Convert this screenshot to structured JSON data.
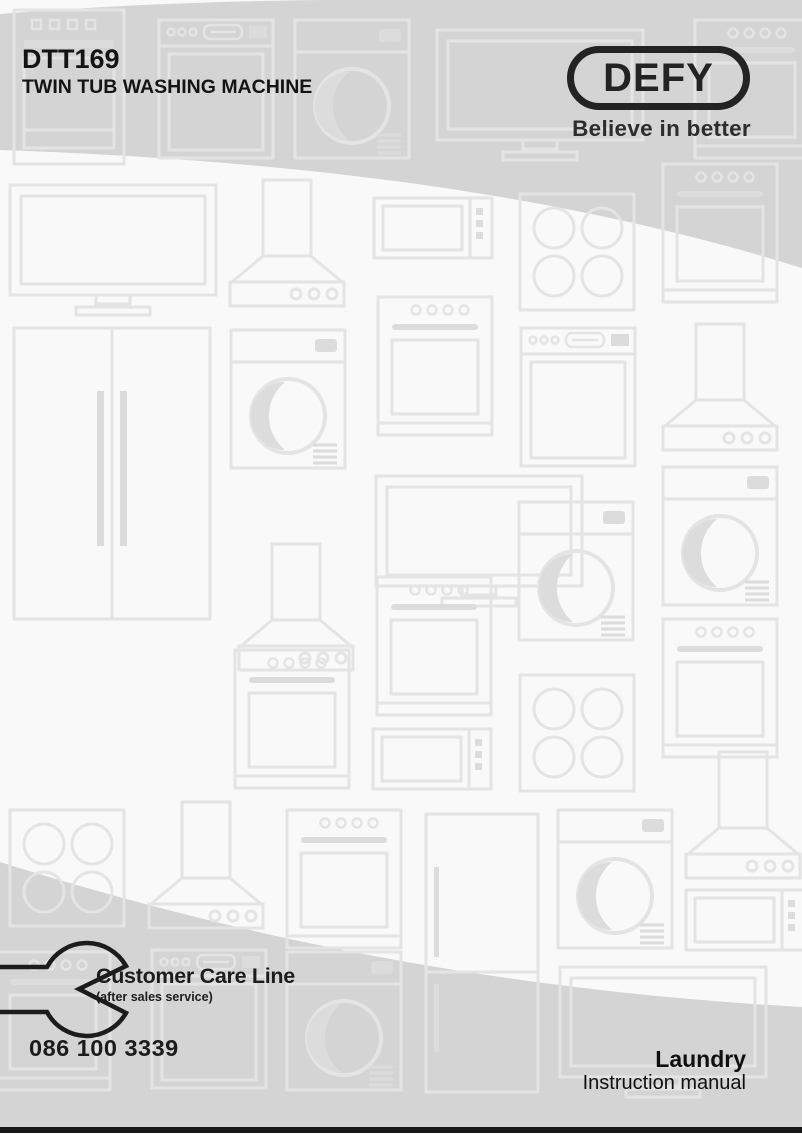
{
  "header": {
    "model": "DTT169",
    "subtitle": "TWIN TUB WASHING MACHINE"
  },
  "brand": {
    "logo_text": "DEFY",
    "tagline": "Believe in better"
  },
  "customer_care": {
    "title": "Customer Care Line",
    "subtitle": "(after sales service)",
    "phone": "086 100 3339",
    "icon": "wrench-icon"
  },
  "footer": {
    "category": "Laundry",
    "doc_type": "Instruction manual"
  },
  "colors": {
    "swoosh_gray": "#d4d4d4",
    "page_background": "#f9f9f9",
    "pattern_line": "#e4e4e4",
    "pattern_fill": "#dcdcdc",
    "text": "#1c1c1c",
    "bottom_bar": "#161616"
  },
  "background_pattern_icons": [
    "dishwasher-icon",
    "washing-machine-icon",
    "tv-icon",
    "oven-icon",
    "cooker-hood-icon",
    "microwave-icon",
    "hob-icon",
    "fridge-icon"
  ]
}
